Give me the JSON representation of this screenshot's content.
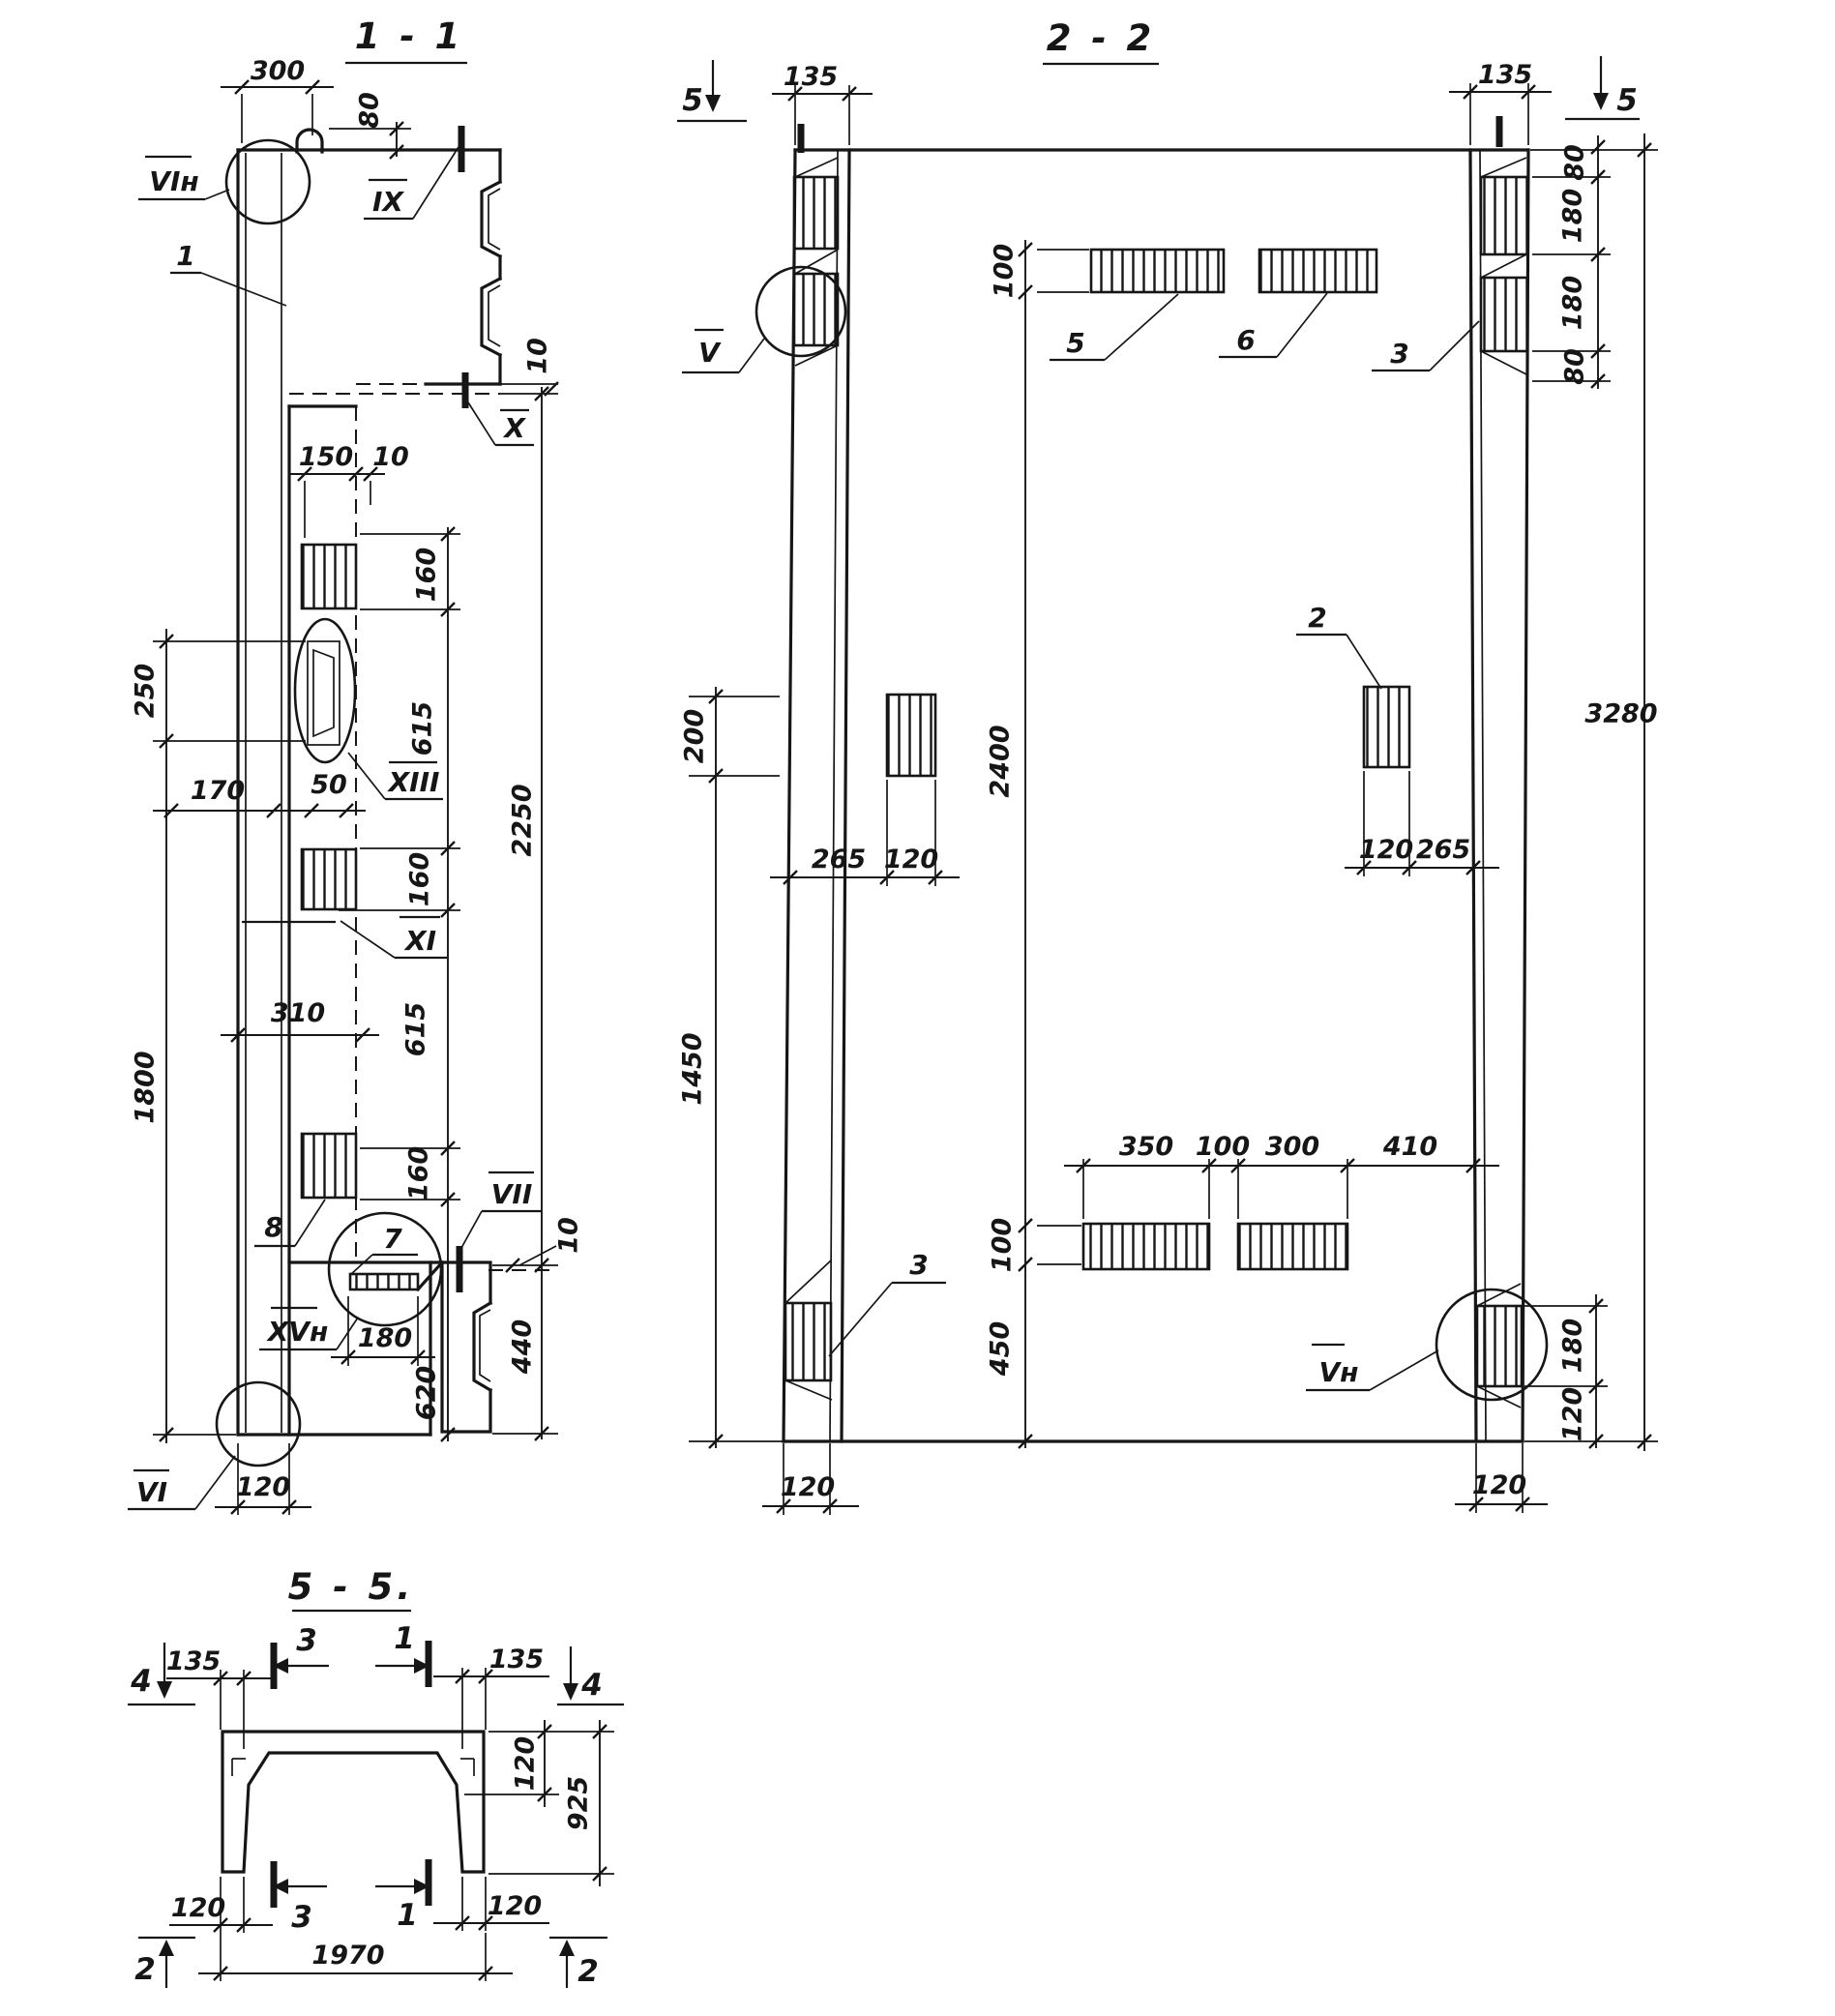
{
  "s11": {
    "title": "1 - 1",
    "d300": "300",
    "d80": "80",
    "d10x": "10",
    "lab_vih": "VIн",
    "lab_1": "1",
    "lab_ix": "IX",
    "lab_x": "X",
    "d150": "150",
    "d10b": "10",
    "d160a": "160",
    "d615a": "615",
    "d160b": "160",
    "d615b": "615",
    "d160c": "160",
    "d2250": "2250",
    "d250": "250",
    "d170": "170",
    "d50": "50",
    "lab_xiii": "XIII",
    "lab_xi": "XI",
    "d310": "310",
    "d1800": "1800",
    "lab_8": "8",
    "lab_7": "7",
    "lab_vii": "VII",
    "d10c": "10",
    "d440": "440",
    "d180": "180",
    "d620": "620",
    "lab_xvh": "XVн",
    "lab_vi": "VI",
    "d120": "120"
  },
  "s22": {
    "title": "2 - 2",
    "m5l": "5",
    "m5r": "5",
    "d135l": "135",
    "d135r": "135",
    "d80a": "80",
    "d180a": "180",
    "d180b": "180",
    "d80b": "80",
    "d3280": "3280",
    "d100t": "100",
    "lab_5": "5",
    "lab_6": "6",
    "lab_3t": "3",
    "lab_v": "V",
    "d200": "200",
    "d2400": "2400",
    "d265l": "265",
    "d120l": "120",
    "d120r": "120",
    "d265r": "265",
    "lab_2": "2",
    "d1450": "1450",
    "d350": "350",
    "d100m": "100",
    "d300": "300",
    "d410": "410",
    "d100b": "100",
    "d450": "450",
    "lab_3b": "3",
    "lab_vnh": "Vн",
    "d180r": "180",
    "d120rb": "120",
    "d120bl": "120",
    "d120br": "120"
  },
  "s55": {
    "title": "5 - 5.",
    "m4l": "4",
    "m4r": "4",
    "m3t": "3",
    "m1t": "1",
    "m3b": "3",
    "m1b": "1",
    "m2l": "2",
    "m2r": "2",
    "d135l": "135",
    "d135r": "135",
    "d120t": "120",
    "d925": "925",
    "d120bl": "120",
    "d120br": "120",
    "d1970": "1970"
  }
}
